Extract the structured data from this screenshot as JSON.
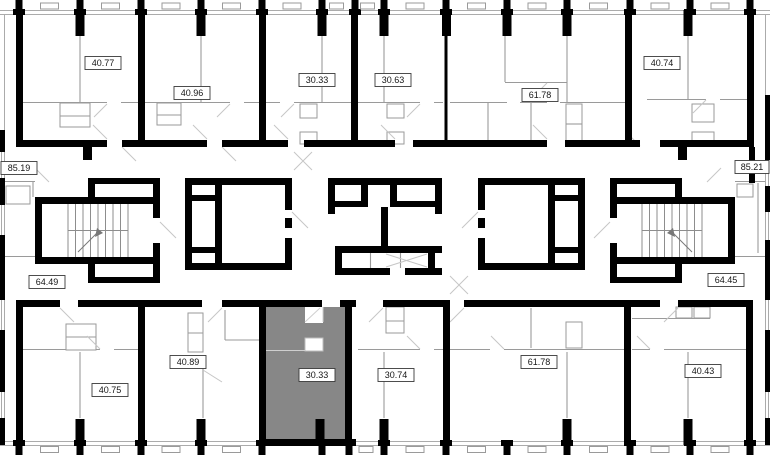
{
  "colors": {
    "wall": "#000000",
    "partition": "#9a9a9a",
    "highlight": "#878787",
    "label_background": "#ffffff",
    "label_border": "#3a3a3a"
  },
  "selected_unit": {
    "area": "30.33",
    "row": "bottom"
  },
  "units": {
    "top": [
      {
        "area": "40.77"
      },
      {
        "area": "40.96"
      },
      {
        "area": "30.33"
      },
      {
        "area": "30.63"
      },
      {
        "area": "61.78"
      },
      {
        "area": "40.74"
      }
    ],
    "middle": [
      {
        "area": "85.19"
      },
      {
        "area": "85.21"
      },
      {
        "area": "64.49"
      },
      {
        "area": "64.45"
      }
    ],
    "bottom": [
      {
        "area": "40.75"
      },
      {
        "area": "40.89"
      },
      {
        "area": "30.33"
      },
      {
        "area": "30.74"
      },
      {
        "area": "61.78"
      },
      {
        "area": "40.43"
      }
    ]
  }
}
